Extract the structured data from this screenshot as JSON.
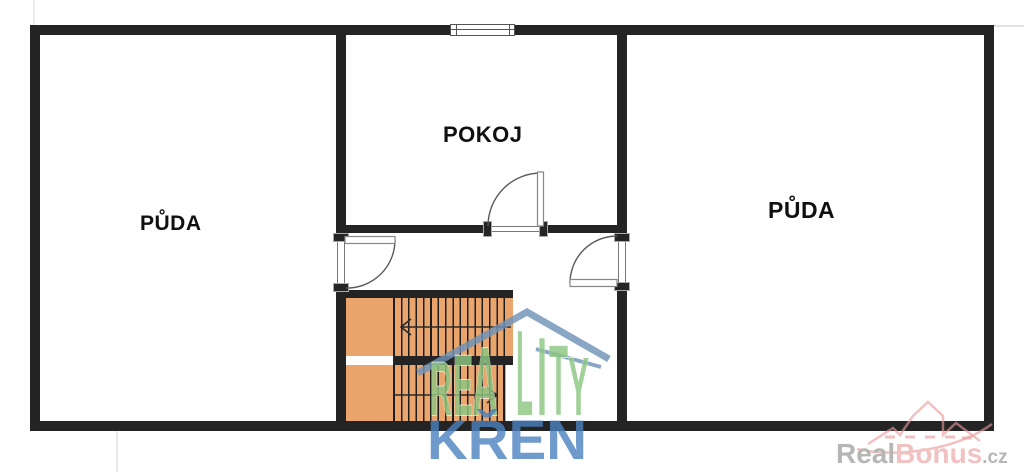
{
  "floorplan": {
    "rooms": [
      {
        "id": "puda-left",
        "label": "PŮDA"
      },
      {
        "id": "pokoj",
        "label": "POKOJ"
      },
      {
        "id": "puda-right",
        "label": "PŮDA"
      }
    ]
  },
  "watermark": {
    "reality_letters": [
      "R",
      "E",
      "A",
      "L",
      "I",
      "T",
      "Y"
    ],
    "word_bottom": "KŘEN"
  },
  "brand": {
    "part1": "Real",
    "part2": "Bonus",
    "part3": ".cz"
  },
  "colors": {
    "wall": "#242424",
    "tread": "#1e1e1e",
    "stairs": "#e9a56c",
    "green": "#8dc783",
    "blue": "#4a82c0",
    "roof": "#6f93b8",
    "pink": "#e89b9b",
    "brand_gray": "#b6b6b6",
    "brand_pink": "#f0c2c2"
  }
}
